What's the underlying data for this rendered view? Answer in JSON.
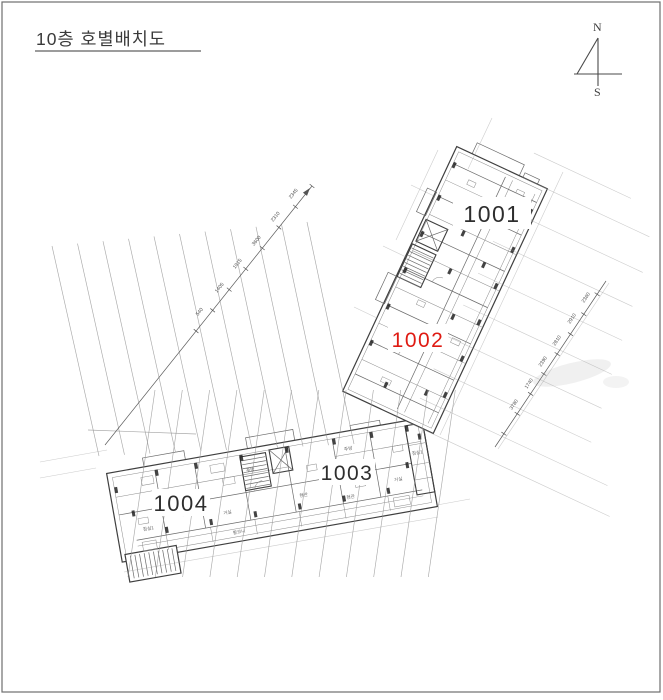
{
  "title": "10층 호별배치도",
  "compass": {
    "north": "N",
    "south": "S"
  },
  "units": [
    {
      "id": "1001",
      "label": "1001",
      "color": "#2e2e2e",
      "highlighted": false
    },
    {
      "id": "1002",
      "label": "1002",
      "color": "#df1a12",
      "highlighted": true
    },
    {
      "id": "1003",
      "label": "1003",
      "color": "#2e2e2e",
      "highlighted": false
    },
    {
      "id": "1004",
      "label": "1004",
      "color": "#2e2e2e",
      "highlighted": false
    }
  ],
  "colors": {
    "highlight": "#df1a12",
    "ink": "#3f3f3f",
    "grid": "#949494",
    "background": "#ffffff"
  },
  "dimensions": {
    "upper_left_chain": [
      "540",
      "1405",
      "1915",
      "3600",
      "2310",
      "2345"
    ],
    "right_chain": [
      "2360",
      "2910",
      "2810",
      "2390",
      "1740",
      "3780"
    ]
  },
  "room_labels": {
    "unit_1004": [
      "침실1",
      "거실",
      "주방",
      "현관",
      "발코니"
    ],
    "unit_1003": [
      "주방",
      "거실",
      "현관",
      "침실1"
    ]
  }
}
